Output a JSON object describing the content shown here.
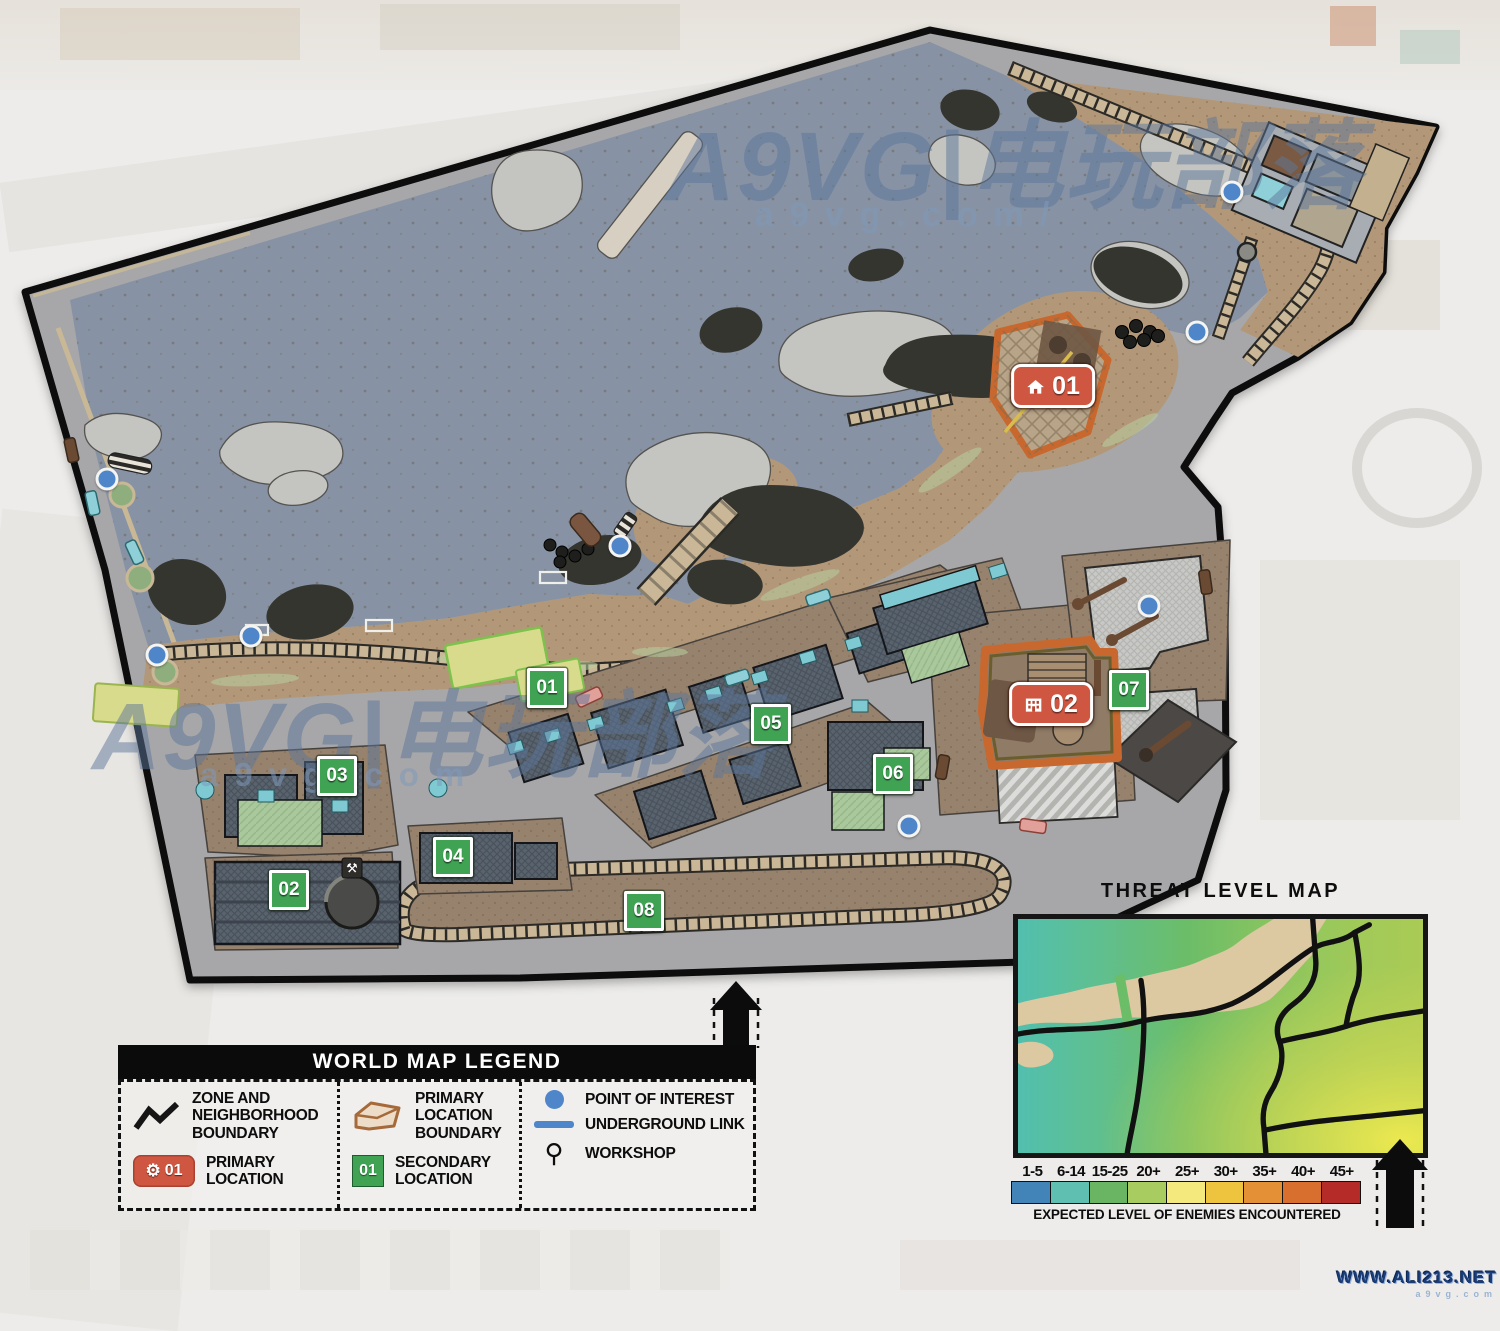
{
  "watermarks": {
    "brand_top": "A9VG|电玩部落",
    "brand_top_sub": "a9vg.com/",
    "brand_mid": "A9VG|电玩部落",
    "brand_mid_sub": "a9vg.com",
    "site": "WWW.ALI213.NET",
    "site_sub": "a9vg.com"
  },
  "map": {
    "primary_markers": [
      {
        "id": "01",
        "icon": "house",
        "x": 1053,
        "y": 386
      },
      {
        "id": "02",
        "icon": "building",
        "x": 1051,
        "y": 704
      }
    ],
    "secondary_markers": [
      {
        "id": "01",
        "x": 547,
        "y": 688
      },
      {
        "id": "02",
        "x": 289,
        "y": 890
      },
      {
        "id": "03",
        "x": 337,
        "y": 776
      },
      {
        "id": "04",
        "x": 453,
        "y": 857
      },
      {
        "id": "05",
        "x": 771,
        "y": 724
      },
      {
        "id": "06",
        "x": 893,
        "y": 774
      },
      {
        "id": "07",
        "x": 1129,
        "y": 690
      },
      {
        "id": "08",
        "x": 644,
        "y": 911
      }
    ],
    "points_of_interest": [
      {
        "x": 107,
        "y": 479
      },
      {
        "x": 157,
        "y": 655
      },
      {
        "x": 251,
        "y": 636
      },
      {
        "x": 620,
        "y": 546
      },
      {
        "x": 909,
        "y": 826
      },
      {
        "x": 1149,
        "y": 606
      },
      {
        "x": 1197,
        "y": 332
      },
      {
        "x": 1232,
        "y": 192
      }
    ],
    "workshops": [
      {
        "x": 352,
        "y": 868
      }
    ],
    "colors": {
      "water": "#8793a4",
      "sand": "#b29878",
      "street": "#a7a7a9",
      "sidewalk": "#97826d",
      "primary_marker": "#cf5742",
      "secondary_marker": "#3fa353",
      "poi": "#4f86c9",
      "location_boundary": "#c8682e"
    }
  },
  "legend": {
    "title": "WORLD MAP LEGEND",
    "items": [
      {
        "icon": "zigzag-line",
        "label": "ZONE AND NEIGHBORHOOD BOUNDARY"
      },
      {
        "icon": "primary-location-pill",
        "pill_text": "01",
        "label": "PRIMARY LOCATION"
      },
      {
        "icon": "primary-boundary-polygon",
        "label": "PRIMARY LOCATION BOUNDARY"
      },
      {
        "icon": "secondary-location-square",
        "square_text": "01",
        "label": "SECONDARY LOCATION"
      },
      {
        "icon": "poi-dot",
        "label": "POINT OF INTEREST"
      },
      {
        "icon": "underground-line",
        "label": "UNDERGROUND LINK"
      },
      {
        "icon": "workshop-tools",
        "label": "WORKSHOP"
      }
    ]
  },
  "threat_map": {
    "title": "THREAT LEVEL MAP",
    "caption": "EXPECTED LEVEL OF ENEMIES ENCOUNTERED",
    "scale": [
      {
        "label": "1-5",
        "color": "#4384b8"
      },
      {
        "label": "6-14",
        "color": "#5fc0b2"
      },
      {
        "label": "15-25",
        "color": "#6ab563"
      },
      {
        "label": "20+",
        "color": "#a8cc5f"
      },
      {
        "label": "25+",
        "color": "#f3e97c"
      },
      {
        "label": "30+",
        "color": "#eec43f"
      },
      {
        "label": "35+",
        "color": "#e39036"
      },
      {
        "label": "40+",
        "color": "#d96f2e"
      },
      {
        "label": "45+",
        "color": "#b52b27"
      }
    ]
  }
}
